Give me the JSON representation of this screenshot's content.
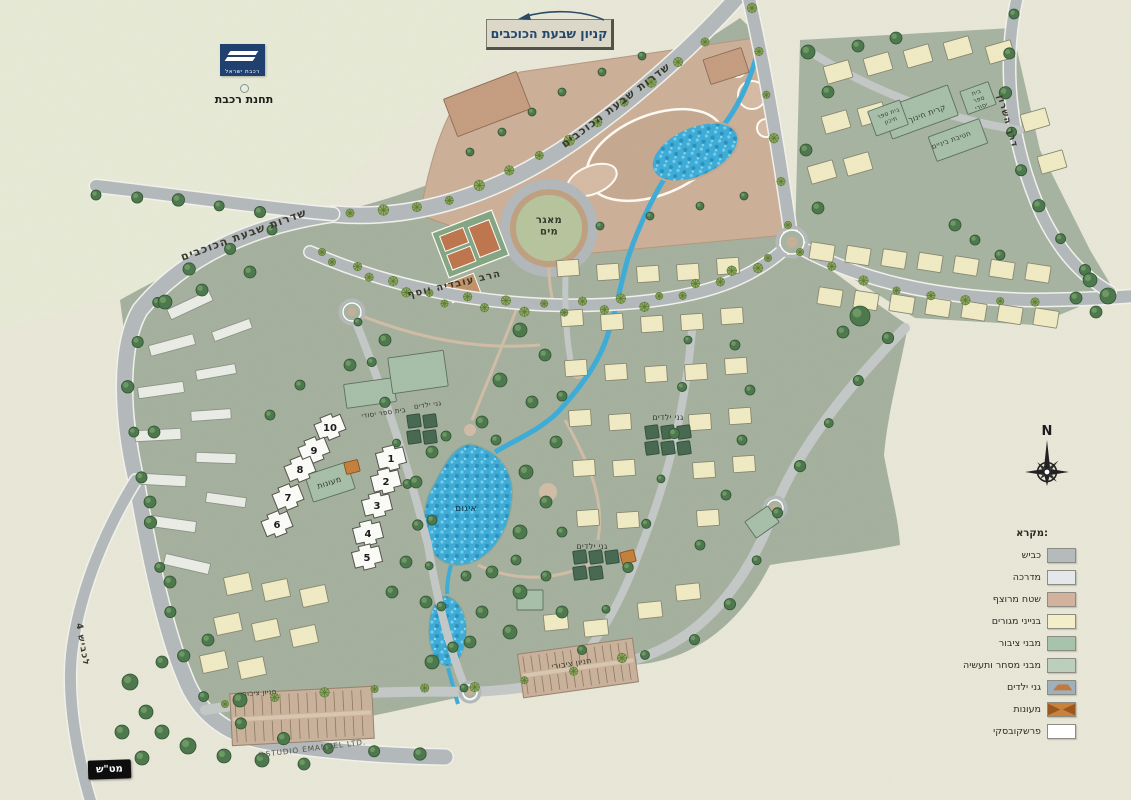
{
  "sign": {
    "title": "קניון שבעת הכוכבים"
  },
  "railway": {
    "brand": "רכבת ישראל",
    "station": "תחנת רכבת"
  },
  "compass": {
    "north": "N"
  },
  "plant_box": {
    "label": "מט\"ש"
  },
  "legend": {
    "heading": "מקרא:",
    "items": [
      {
        "name": "road",
        "label": "כביש",
        "color": "#b5babd",
        "style": "plain"
      },
      {
        "name": "sidewalk",
        "label": "מדרכה",
        "color": "#e4e8ea",
        "style": "plain"
      },
      {
        "name": "paved-area",
        "label": "שטח מרוצף",
        "color": "#d2b29c",
        "style": "plain"
      },
      {
        "name": "residential-buildings",
        "label": "בנייני מגורים",
        "color": "#f3eec8",
        "style": "plain"
      },
      {
        "name": "public-buildings",
        "label": "מבני ציבור",
        "color": "#a8c3ac",
        "style": "plain"
      },
      {
        "name": "commerce-industry-buildings",
        "label": "מבני מסחר ותעשיה",
        "color": "#bccfbc",
        "style": "plain"
      },
      {
        "name": "kindergartens",
        "label": "גני ילדים",
        "color": "#9fb0bd",
        "style": "kindergarten"
      },
      {
        "name": "daycares",
        "label": "מעונות",
        "color": "#c8823e",
        "style": "daycare"
      },
      {
        "name": "prashkovsky",
        "label": "פרשקובסקי",
        "color": "#ffffff",
        "style": "plain"
      }
    ]
  },
  "map": {
    "street_labels": [
      {
        "name": "street-shivat-hakokhavim-north",
        "text": "שדרות שבעת הכוכבים",
        "x": 618,
        "y": 108,
        "rotate": -37,
        "size": 11
      },
      {
        "name": "street-shivat-hakokhavim-west",
        "text": "שדרות שבעת הכוכבים",
        "x": 245,
        "y": 238,
        "rotate": -20,
        "size": 11
      },
      {
        "name": "street-ovadia-yosef",
        "text": "הרב עובדיה יוסף",
        "x": 455,
        "y": 287,
        "rotate": -13,
        "size": 10
      },
      {
        "name": "street-hasharon-east",
        "text": "דרך השרון",
        "x": 1005,
        "y": 122,
        "rotate": 74,
        "size": 9
      },
      {
        "name": "road-to-highway-west",
        "text": "לכביש 4",
        "x": 80,
        "y": 645,
        "rotate": 80,
        "size": 9
      }
    ],
    "area_labels": [
      {
        "name": "water-reservoir",
        "lines": [
          "מאגר",
          "מים"
        ],
        "x": 549,
        "y": 223,
        "size": 10,
        "bold": true
      },
      {
        "name": "lake",
        "lines": [
          "איגום"
        ],
        "x": 466,
        "y": 511,
        "size": 9,
        "color": "#133646"
      },
      {
        "name": "elementary-school-west",
        "lines": [
          "בית ספר יסודי"
        ],
        "x": 384,
        "y": 415,
        "size": 7,
        "rotate": -8
      },
      {
        "name": "kindergartens-west",
        "lines": [
          "גני ילדים"
        ],
        "x": 428,
        "y": 407,
        "size": 7,
        "rotate": -8
      },
      {
        "name": "daycare-building",
        "lines": [
          "מעונות"
        ],
        "x": 330,
        "y": 485,
        "size": 8,
        "rotate": -18,
        "color": "#2f3a2f"
      },
      {
        "name": "kindergartens-center",
        "lines": [
          "גני ילדים"
        ],
        "x": 668,
        "y": 420,
        "size": 8
      },
      {
        "name": "kindergartens-south",
        "lines": [
          "גני ילדים"
        ],
        "x": 592,
        "y": 549,
        "size": 8
      },
      {
        "name": "education-campus",
        "lines": [
          "קרית חינוך"
        ],
        "x": 928,
        "y": 116,
        "size": 8,
        "rotate": -20,
        "color": "#33402f"
      },
      {
        "name": "middle-school",
        "lines": [
          "חטיבת ביניים"
        ],
        "x": 952,
        "y": 142,
        "size": 7,
        "rotate": -20,
        "color": "#33402f"
      },
      {
        "name": "high-school",
        "lines": [
          "בית ספר",
          "תיכון"
        ],
        "x": 889,
        "y": 115,
        "size": 6,
        "rotate": -20,
        "color": "#33402f"
      },
      {
        "name": "elementary-school-east",
        "lines": [
          "בית",
          "ספר",
          "יסודי"
        ],
        "x": 977,
        "y": 94,
        "size": 6,
        "rotate": -20,
        "color": "#33402f"
      },
      {
        "name": "public-parking-central",
        "lines": [
          "חניון ציבורי"
        ],
        "x": 572,
        "y": 666,
        "size": 8,
        "rotate": -9
      },
      {
        "name": "public-parking-west",
        "lines": [
          "חניון ציבורי"
        ],
        "x": 259,
        "y": 695,
        "size": 7,
        "rotate": -4
      },
      {
        "name": "studio-credit",
        "lines": [
          "©STUDIO EMANUEL LTD."
        ],
        "x": 312,
        "y": 751,
        "size": 7.5,
        "rotate": -7,
        "color": "#54554d",
        "spacing": 0.8
      }
    ],
    "numbered_buildings": [
      {
        "n": "10",
        "x": 330,
        "y": 427,
        "rot": -22
      },
      {
        "n": "9",
        "x": 314,
        "y": 450,
        "rot": -22
      },
      {
        "n": "8",
        "x": 300,
        "y": 469,
        "rot": -22
      },
      {
        "n": "7",
        "x": 288,
        "y": 497,
        "rot": -22
      },
      {
        "n": "6",
        "x": 277,
        "y": 524,
        "rot": -22
      },
      {
        "n": "1",
        "x": 391,
        "y": 458,
        "rot": -14
      },
      {
        "n": "2",
        "x": 386,
        "y": 481,
        "rot": -14
      },
      {
        "n": "3",
        "x": 377,
        "y": 505,
        "rot": -14
      },
      {
        "n": "4",
        "x": 368,
        "y": 533,
        "rot": -14
      },
      {
        "n": "5",
        "x": 367,
        "y": 557,
        "rot": -14
      }
    ]
  }
}
